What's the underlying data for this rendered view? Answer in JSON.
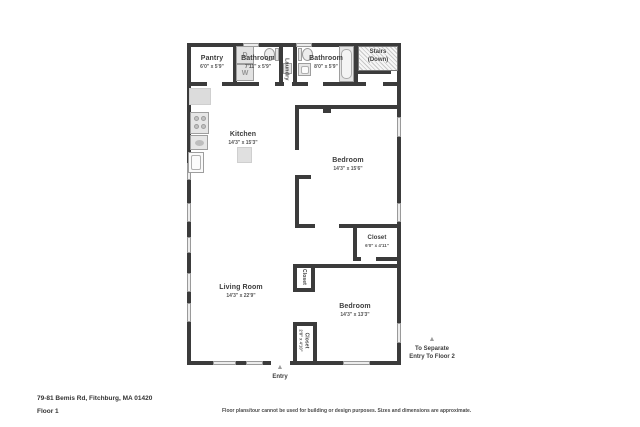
{
  "meta": {
    "address": "79-81 Bemis Rd, Fitchburg, MA 01420",
    "floor_label": "Floor 1",
    "disclaimer": "Floor plans/tour cannot be used for building or design purposes. Sizes and dimensions are approximate."
  },
  "colors": {
    "wall": "#3b3b3b",
    "window": "#ececec",
    "fixture_fill": "#e6e6e6",
    "fixture_border": "#9e9e9e",
    "arrow": "#9c9c9c",
    "room_label": "#3d3d3d",
    "dimension_text": "#555555"
  },
  "rooms": {
    "pantry": {
      "name": "Pantry",
      "dims": "6'0\" x 5'9\""
    },
    "bathroom_left": {
      "name": "Bathroom",
      "dims": "7'11\" x 5'9\""
    },
    "laundry": {
      "name": "Laundry"
    },
    "bathroom_right": {
      "name": "Bathroom",
      "dims": "8'0\" x 5'9\""
    },
    "stairs": {
      "name": "Stairs",
      "sub": "(Down)"
    },
    "kitchen": {
      "name": "Kitchen",
      "dims": "14'3\" x 15'3\""
    },
    "bedroom_top": {
      "name": "Bedroom",
      "dims": "14'3\" x 15'6\""
    },
    "closet_right": {
      "name": "Closet",
      "dims": "6'0\" x 4'11\""
    },
    "closet_mid": {
      "name": "Closet"
    },
    "bedroom_bottom": {
      "name": "Bedroom",
      "dims": "14'3\" x 13'3\""
    },
    "closet_bottom": {
      "name": "Closet",
      "dims": "2'8\" x 4'10\""
    },
    "living_room": {
      "name": "Living Room",
      "dims": "14'3\" x 22'9\""
    }
  },
  "fixtures": {
    "dryer_label": "D",
    "washer_label": "W"
  },
  "annotations": {
    "entry": {
      "label": "Entry",
      "arrow": "▲"
    },
    "separate_entry": {
      "line1": "To Separate",
      "line2": "Entry To Floor 2",
      "arrow": "▲"
    }
  }
}
